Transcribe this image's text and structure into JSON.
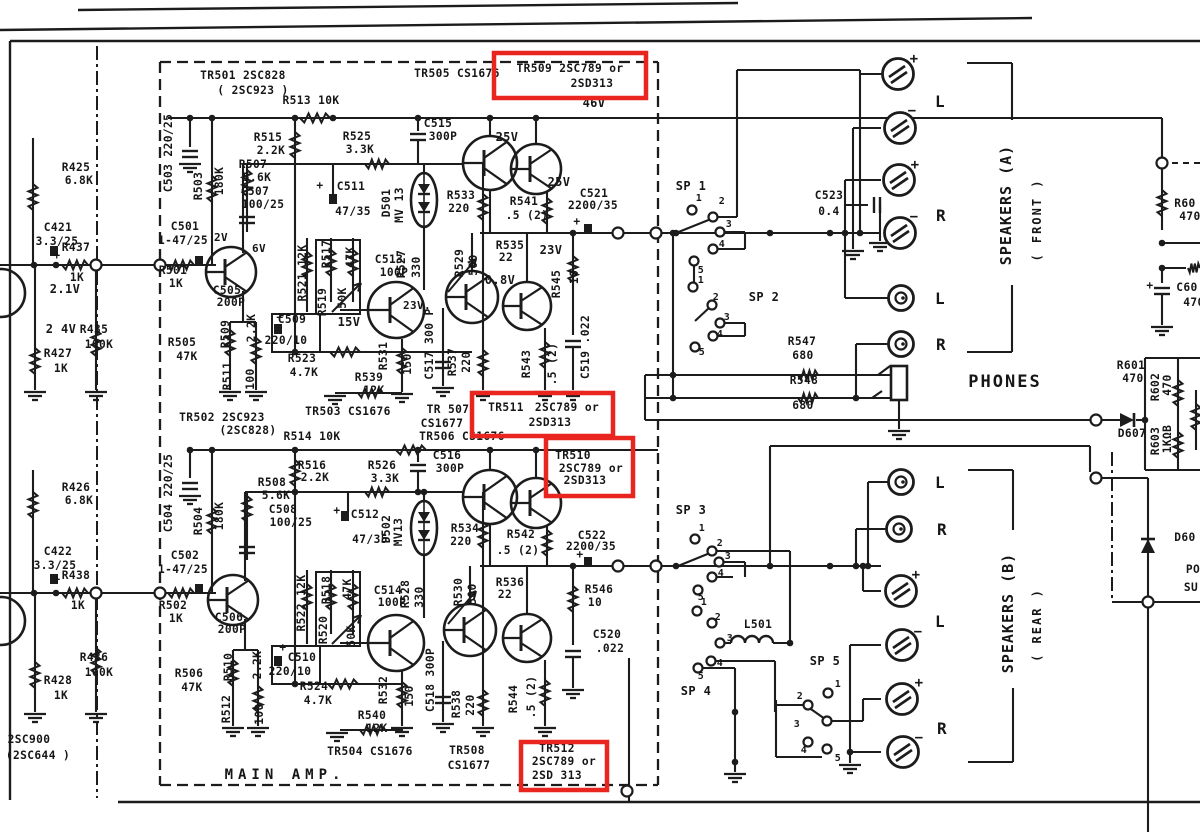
{
  "meta": {
    "document_type": "scanned circuit schematic",
    "section_title": "MAIN AMP",
    "ink_color": "#1c1c1c",
    "paper_color": "#ffffff",
    "highlight_color": "#e8251f"
  },
  "highlights": [
    {
      "name": "tr509-highlight",
      "x": 494,
      "y": 53,
      "w": 152,
      "h": 45
    },
    {
      "name": "tr511-highlight",
      "x": 472,
      "y": 393,
      "w": 141,
      "h": 43
    },
    {
      "name": "tr510-highlight",
      "x": 546,
      "y": 438,
      "w": 87,
      "h": 58
    },
    {
      "name": "tr512-highlight",
      "x": 521,
      "y": 742,
      "w": 86,
      "h": 48
    }
  ],
  "labels": [
    {
      "t": "TR501 2SC828",
      "x": 243,
      "y": 79
    },
    {
      "t": "( 2SC923 )",
      "x": 253,
      "y": 94
    },
    {
      "t": "TR505 CS1676",
      "x": 457,
      "y": 77
    },
    {
      "t": "TR509 2SC789 or",
      "x": 570,
      "y": 72
    },
    {
      "t": "2SD313",
      "x": 592,
      "y": 87
    },
    {
      "t": "46V",
      "x": 594,
      "y": 107,
      "fs": 12
    },
    {
      "t": "R513 10K",
      "x": 311,
      "y": 104
    },
    {
      "t": "R515",
      "x": 268,
      "y": 141
    },
    {
      "t": "2.2K",
      "x": 271,
      "y": 154
    },
    {
      "t": "R525",
      "x": 357,
      "y": 140
    },
    {
      "t": "3.3K",
      "x": 360,
      "y": 153
    },
    {
      "t": "C515",
      "x": 438,
      "y": 127
    },
    {
      "t": "300P",
      "x": 443,
      "y": 140
    },
    {
      "t": "25V",
      "x": 507,
      "y": 141,
      "fs": 12
    },
    {
      "t": "25V",
      "x": 559,
      "y": 186,
      "fs": 12
    },
    {
      "t": "R507",
      "x": 253,
      "y": 168
    },
    {
      "t": "5.6K",
      "x": 257,
      "y": 181
    },
    {
      "t": "C507",
      "x": 255,
      "y": 195
    },
    {
      "t": "100/25",
      "x": 263,
      "y": 208
    },
    {
      "t": "+",
      "x": 320,
      "y": 189
    },
    {
      "t": "C511",
      "x": 351,
      "y": 190
    },
    {
      "t": "47/35",
      "x": 353,
      "y": 215
    },
    {
      "t": "D501",
      "x": 390,
      "y": 203,
      "v": 1
    },
    {
      "t": "MV 13",
      "x": 403,
      "y": 205,
      "v": 1
    },
    {
      "t": "R533",
      "x": 461,
      "y": 199
    },
    {
      "t": "220",
      "x": 459,
      "y": 212
    },
    {
      "t": "R541",
      "x": 524,
      "y": 205
    },
    {
      "t": ".5 (2)",
      "x": 527,
      "y": 219
    },
    {
      "t": "C521",
      "x": 594,
      "y": 197
    },
    {
      "t": "2200/35",
      "x": 593,
      "y": 209
    },
    {
      "t": "+",
      "x": 577,
      "y": 225
    },
    {
      "t": "R535",
      "x": 510,
      "y": 249
    },
    {
      "t": "22",
      "x": 506,
      "y": 261
    },
    {
      "t": "23V",
      "x": 551,
      "y": 254,
      "fs": 12
    },
    {
      "t": "R545",
      "x": 560,
      "y": 284,
      "v": 1
    },
    {
      "t": "10",
      "x": 578,
      "y": 277,
      "v": 1
    },
    {
      "t": "0.8V",
      "x": 500,
      "y": 284,
      "fs": 12
    },
    {
      "t": "23V.",
      "x": 417,
      "y": 309,
      "fs": 11
    },
    {
      "t": "C519 .022",
      "x": 589,
      "y": 347,
      "v": 1
    },
    {
      "t": "R543",
      "x": 530,
      "y": 364,
      "v": 1
    },
    {
      "t": ".5 (2)",
      "x": 556,
      "y": 364,
      "v": 1
    },
    {
      "t": "R537",
      "x": 456,
      "y": 362,
      "v": 1
    },
    {
      "t": "220",
      "x": 470,
      "y": 362,
      "v": 1
    },
    {
      "t": "C517 300 P",
      "x": 433,
      "y": 344,
      "v": 1
    },
    {
      "t": "R531",
      "x": 387,
      "y": 356,
      "v": 1
    },
    {
      "t": "150",
      "x": 411,
      "y": 364,
      "v": 1
    },
    {
      "t": "15V",
      "x": 349,
      "y": 326,
      "fs": 12
    },
    {
      "t": "R521 12K",
      "x": 306,
      "y": 273,
      "v": 1
    },
    {
      "t": "R517",
      "x": 330,
      "y": 254,
      "v": 1
    },
    {
      "t": "R519",
      "x": 326,
      "y": 302,
      "v": 1
    },
    {
      "t": "50K",
      "x": 346,
      "y": 298,
      "v": 1
    },
    {
      "t": "47K",
      "x": 354,
      "y": 257,
      "v": 1
    },
    {
      "t": "C513",
      "x": 389,
      "y": 263
    },
    {
      "t": "100P",
      "x": 394,
      "y": 276
    },
    {
      "t": "R527",
      "x": 405,
      "y": 264,
      "v": 1
    },
    {
      "t": "330",
      "x": 420,
      "y": 267,
      "v": 1
    },
    {
      "t": "R529",
      "x": 463,
      "y": 263,
      "v": 1
    },
    {
      "t": "500",
      "x": 477,
      "y": 265,
      "v": 1
    },
    {
      "t": "+",
      "x": 280,
      "y": 321
    },
    {
      "t": "C509",
      "x": 292,
      "y": 323
    },
    {
      "t": "220/10",
      "x": 286,
      "y": 344
    },
    {
      "t": "R509",
      "x": 229,
      "y": 334,
      "v": 1
    },
    {
      "t": "2.2K",
      "x": 255,
      "y": 328,
      "v": 1
    },
    {
      "t": "R511",
      "x": 231,
      "y": 376,
      "v": 1
    },
    {
      "t": "100",
      "x": 254,
      "y": 379,
      "v": 1
    },
    {
      "t": "R523",
      "x": 302,
      "y": 362
    },
    {
      "t": "4.7K",
      "x": 304,
      "y": 376
    },
    {
      "t": "R539",
      "x": 369,
      "y": 381
    },
    {
      "t": "12K",
      "x": 374,
      "y": 394
    },
    {
      "t": "TR503 CS1676",
      "x": 348,
      "y": 415
    },
    {
      "t": "TR 507",
      "x": 448,
      "y": 413
    },
    {
      "t": "CS1677",
      "x": 442,
      "y": 427
    },
    {
      "t": "TR511",
      "x": 506,
      "y": 411
    },
    {
      "t": "2SC789 or",
      "x": 567,
      "y": 411
    },
    {
      "t": "2SD313",
      "x": 550,
      "y": 426
    },
    {
      "t": "TR506 CS1676",
      "x": 462,
      "y": 440
    },
    {
      "t": "6V",
      "x": 259,
      "y": 252,
      "fs": 11
    },
    {
      "t": "R425",
      "x": 76,
      "y": 171
    },
    {
      "t": "6.8K",
      "x": 79,
      "y": 184
    },
    {
      "t": "C421",
      "x": 58,
      "y": 231
    },
    {
      "t": "3.3/25",
      "x": 57,
      "y": 245
    },
    {
      "t": "+",
      "x": 57,
      "y": 259
    },
    {
      "t": "R437",
      "x": 76,
      "y": 251
    },
    {
      "t": "1K",
      "x": 77,
      "y": 281
    },
    {
      "t": "2.1V",
      "x": 65,
      "y": 293,
      "fs": 12
    },
    {
      "t": "2 4V",
      "x": 61,
      "y": 333,
      "fs": 12
    },
    {
      "t": "R427",
      "x": 58,
      "y": 357
    },
    {
      "t": "1K",
      "x": 61,
      "y": 372
    },
    {
      "t": "R435",
      "x": 94,
      "y": 333
    },
    {
      "t": "100K",
      "x": 99,
      "y": 348
    },
    {
      "t": "C503 220/25",
      "x": 172,
      "y": 153,
      "v": 1
    },
    {
      "t": "R503",
      "x": 202,
      "y": 186,
      "v": 1
    },
    {
      "t": "180K",
      "x": 223,
      "y": 181,
      "v": 1
    },
    {
      "t": "C501",
      "x": 185,
      "y": 230
    },
    {
      "t": "1-47/25",
      "x": 183,
      "y": 244
    },
    {
      "t": "2V",
      "x": 221,
      "y": 241,
      "fs": 11
    },
    {
      "t": "R501",
      "x": 173,
      "y": 274
    },
    {
      "t": "1K",
      "x": 176,
      "y": 287
    },
    {
      "t": "C505",
      "x": 227,
      "y": 294
    },
    {
      "t": "200P",
      "x": 231,
      "y": 306
    },
    {
      "t": "R505",
      "x": 182,
      "y": 346
    },
    {
      "t": "47K",
      "x": 187,
      "y": 360
    },
    {
      "t": "R426",
      "x": 76,
      "y": 491
    },
    {
      "t": "6.8K",
      "x": 79,
      "y": 504
    },
    {
      "t": "C422",
      "x": 58,
      "y": 555
    },
    {
      "t": "3.3/25",
      "x": 55,
      "y": 569
    },
    {
      "t": "+",
      "x": 57,
      "y": 583
    },
    {
      "t": "R438",
      "x": 76,
      "y": 579
    },
    {
      "t": "1K",
      "x": 78,
      "y": 609
    },
    {
      "t": "R436",
      "x": 94,
      "y": 661
    },
    {
      "t": "100K",
      "x": 99,
      "y": 676
    },
    {
      "t": "R428",
      "x": 58,
      "y": 684
    },
    {
      "t": "1K",
      "x": 61,
      "y": 699
    },
    {
      "t": "2SC900",
      "x": 29,
      "y": 743
    },
    {
      "t": "(2SC644 )",
      "x": 38,
      "y": 759
    },
    {
      "t": "C504 220/25",
      "x": 172,
      "y": 493,
      "v": 1
    },
    {
      "t": "R504",
      "x": 202,
      "y": 521,
      "v": 1
    },
    {
      "t": "180K",
      "x": 223,
      "y": 516,
      "v": 1
    },
    {
      "t": "C502",
      "x": 185,
      "y": 559
    },
    {
      "t": "1-47/25",
      "x": 183,
      "y": 573
    },
    {
      "t": "R502",
      "x": 173,
      "y": 609
    },
    {
      "t": "1K",
      "x": 176,
      "y": 622
    },
    {
      "t": "C506",
      "x": 229,
      "y": 621
    },
    {
      "t": "200P",
      "x": 232,
      "y": 633
    },
    {
      "t": "R506",
      "x": 189,
      "y": 677
    },
    {
      "t": "47K",
      "x": 192,
      "y": 691
    },
    {
      "t": "TR502 2SC923",
      "x": 222,
      "y": 421
    },
    {
      "t": "(2SC828)",
      "x": 248,
      "y": 434
    },
    {
      "t": "R514 10K",
      "x": 312,
      "y": 440
    },
    {
      "t": "R516",
      "x": 312,
      "y": 469
    },
    {
      "t": "2.2K",
      "x": 315,
      "y": 481
    },
    {
      "t": "R526",
      "x": 382,
      "y": 469
    },
    {
      "t": "3.3K",
      "x": 385,
      "y": 482
    },
    {
      "t": "C516",
      "x": 447,
      "y": 459
    },
    {
      "t": "300P",
      "x": 450,
      "y": 472
    },
    {
      "t": "R508",
      "x": 272,
      "y": 486
    },
    {
      "t": "5.6K",
      "x": 276,
      "y": 499
    },
    {
      "t": "C508",
      "x": 283,
      "y": 513
    },
    {
      "t": "100/25",
      "x": 291,
      "y": 526
    },
    {
      "t": "+",
      "x": 337,
      "y": 514
    },
    {
      "t": "C512",
      "x": 365,
      "y": 518
    },
    {
      "t": "47/35",
      "x": 370,
      "y": 543
    },
    {
      "t": "D502",
      "x": 390,
      "y": 529,
      "v": 1
    },
    {
      "t": "MV13",
      "x": 402,
      "y": 532,
      "v": 1
    },
    {
      "t": "R534",
      "x": 465,
      "y": 532
    },
    {
      "t": "220",
      "x": 461,
      "y": 545
    },
    {
      "t": "R542",
      "x": 521,
      "y": 538
    },
    {
      "t": ".5 (2)",
      "x": 518,
      "y": 554
    },
    {
      "t": "TR510",
      "x": 573,
      "y": 459
    },
    {
      "t": "2SC789 or",
      "x": 591,
      "y": 472
    },
    {
      "t": "2SD313",
      "x": 585,
      "y": 484
    },
    {
      "t": "C522",
      "x": 592,
      "y": 539
    },
    {
      "t": "2200/35",
      "x": 591,
      "y": 550
    },
    {
      "t": "+",
      "x": 580,
      "y": 558
    },
    {
      "t": "R546",
      "x": 599,
      "y": 593
    },
    {
      "t": "10",
      "x": 595,
      "y": 606
    },
    {
      "t": "C520",
      "x": 607,
      "y": 638
    },
    {
      "t": ".022",
      "x": 610,
      "y": 652
    },
    {
      "t": "R536",
      "x": 510,
      "y": 586
    },
    {
      "t": "22",
      "x": 505,
      "y": 598
    },
    {
      "t": "R522 12K",
      "x": 305,
      "y": 603,
      "v": 1
    },
    {
      "t": "R518",
      "x": 330,
      "y": 590,
      "v": 1
    },
    {
      "t": "47K",
      "x": 351,
      "y": 589,
      "v": 1
    },
    {
      "t": "R520",
      "x": 327,
      "y": 630,
      "v": 1
    },
    {
      "t": "50K",
      "x": 355,
      "y": 636,
      "v": 1
    },
    {
      "t": "C514",
      "x": 388,
      "y": 594
    },
    {
      "t": "100P",
      "x": 392,
      "y": 606
    },
    {
      "t": "R528",
      "x": 409,
      "y": 594,
      "v": 1
    },
    {
      "t": "330",
      "x": 423,
      "y": 597,
      "v": 1
    },
    {
      "t": "R530",
      "x": 462,
      "y": 592,
      "v": 1
    },
    {
      "t": "500",
      "x": 476,
      "y": 594,
      "v": 1
    },
    {
      "t": "+",
      "x": 283,
      "y": 651
    },
    {
      "t": "C510",
      "x": 302,
      "y": 661
    },
    {
      "t": "220/10",
      "x": 290,
      "y": 675
    },
    {
      "t": "R510",
      "x": 232,
      "y": 667,
      "v": 1
    },
    {
      "t": "2.2K",
      "x": 261,
      "y": 665,
      "v": 1
    },
    {
      "t": "R512",
      "x": 230,
      "y": 709,
      "v": 1
    },
    {
      "t": "100",
      "x": 263,
      "y": 714,
      "v": 1
    },
    {
      "t": "R524",
      "x": 314,
      "y": 690
    },
    {
      "t": "4.7K",
      "x": 318,
      "y": 704
    },
    {
      "t": "R540",
      "x": 372,
      "y": 719
    },
    {
      "t": "12K",
      "x": 377,
      "y": 732
    },
    {
      "t": "R532",
      "x": 387,
      "y": 690,
      "v": 1
    },
    {
      "t": "150",
      "x": 413,
      "y": 696,
      "v": 1
    },
    {
      "t": "C518 300P",
      "x": 434,
      "y": 680,
      "v": 1
    },
    {
      "t": "R538",
      "x": 460,
      "y": 704,
      "v": 1
    },
    {
      "t": "220",
      "x": 474,
      "y": 705,
      "v": 1
    },
    {
      "t": "R544",
      "x": 517,
      "y": 699,
      "v": 1
    },
    {
      "t": ".5 (2)",
      "x": 535,
      "y": 697,
      "v": 1
    },
    {
      "t": "TR504 CS1676",
      "x": 370,
      "y": 755
    },
    {
      "t": "TR508",
      "x": 467,
      "y": 754
    },
    {
      "t": "CS1677",
      "x": 469,
      "y": 769
    },
    {
      "t": "TR512",
      "x": 557,
      "y": 752
    },
    {
      "t": "2SC789 or",
      "x": 564,
      "y": 765
    },
    {
      "t": "2SD 313",
      "x": 557,
      "y": 779
    },
    {
      "t": "MAIN  AMP.",
      "x": 285,
      "y": 779,
      "fs": 14,
      "ls": 5
    },
    {
      "t": "SP 1",
      "x": 691,
      "y": 190,
      "fs": 12
    },
    {
      "t": "1",
      "x": 699,
      "y": 201,
      "fs": 10
    },
    {
      "t": "2",
      "x": 722,
      "y": 204,
      "fs": 10
    },
    {
      "t": "3",
      "x": 729,
      "y": 227,
      "fs": 10
    },
    {
      "t": "4",
      "x": 722,
      "y": 247,
      "fs": 10
    },
    {
      "t": "5",
      "x": 701,
      "y": 273,
      "fs": 10
    },
    {
      "t": "SP 2",
      "x": 764,
      "y": 301,
      "fs": 12
    },
    {
      "t": "1",
      "x": 701,
      "y": 283,
      "fs": 10
    },
    {
      "t": "2",
      "x": 716,
      "y": 300,
      "fs": 10
    },
    {
      "t": "3",
      "x": 727,
      "y": 320,
      "fs": 10
    },
    {
      "t": "4",
      "x": 720,
      "y": 337,
      "fs": 10
    },
    {
      "t": "5",
      "x": 702,
      "y": 355,
      "fs": 10
    },
    {
      "t": "C523",
      "x": 829,
      "y": 199
    },
    {
      "t": "0.4",
      "x": 829,
      "y": 215
    },
    {
      "t": "R547",
      "x": 802,
      "y": 345
    },
    {
      "t": "680",
      "x": 803,
      "y": 359
    },
    {
      "t": "R548",
      "x": 804,
      "y": 384
    },
    {
      "t": "680",
      "x": 803,
      "y": 409
    },
    {
      "t": "PHONES",
      "x": 1005,
      "y": 387,
      "fs": 17,
      "ls": 2
    },
    {
      "t": "SP 3",
      "x": 691,
      "y": 514,
      "fs": 12
    },
    {
      "t": "1",
      "x": 702,
      "y": 531,
      "fs": 10
    },
    {
      "t": "2",
      "x": 720,
      "y": 546,
      "fs": 10
    },
    {
      "t": "3",
      "x": 728,
      "y": 559,
      "fs": 10
    },
    {
      "t": "4",
      "x": 721,
      "y": 576,
      "fs": 10
    },
    {
      "t": "5",
      "x": 701,
      "y": 600,
      "fs": 10
    },
    {
      "t": "L501",
      "x": 758,
      "y": 628
    },
    {
      "t": "SP 4",
      "x": 696,
      "y": 695,
      "fs": 12
    },
    {
      "t": "1",
      "x": 704,
      "y": 605,
      "fs": 10
    },
    {
      "t": "2",
      "x": 718,
      "y": 620,
      "fs": 10
    },
    {
      "t": "3",
      "x": 730,
      "y": 641,
      "fs": 10
    },
    {
      "t": "4",
      "x": 720,
      "y": 666,
      "fs": 10
    },
    {
      "t": "5",
      "x": 701,
      "y": 679,
      "fs": 10
    },
    {
      "t": "SP 5",
      "x": 825,
      "y": 665,
      "fs": 12
    },
    {
      "t": "1",
      "x": 838,
      "y": 687,
      "fs": 10
    },
    {
      "t": "2",
      "x": 800,
      "y": 699,
      "fs": 10
    },
    {
      "t": "3",
      "x": 797,
      "y": 727,
      "fs": 10
    },
    {
      "t": "4",
      "x": 804,
      "y": 753,
      "fs": 10
    },
    {
      "t": "5",
      "x": 838,
      "y": 761,
      "fs": 10
    },
    {
      "t": "+",
      "x": 914,
      "y": 63,
      "fs": 14
    },
    {
      "t": "−",
      "x": 912,
      "y": 115,
      "fs": 14
    },
    {
      "t": "+",
      "x": 915,
      "y": 169,
      "fs": 14
    },
    {
      "t": "−",
      "x": 914,
      "y": 221,
      "fs": 14
    },
    {
      "t": "L",
      "x": 940,
      "y": 107,
      "fs": 16
    },
    {
      "t": "R",
      "x": 941,
      "y": 221,
      "fs": 16
    },
    {
      "t": "L",
      "x": 940,
      "y": 304,
      "fs": 16
    },
    {
      "t": "R",
      "x": 941,
      "y": 350,
      "fs": 16
    },
    {
      "t": "SPEAKERS (A)",
      "x": 1011,
      "y": 205,
      "v": 1,
      "fs": 15,
      "ls": 1
    },
    {
      "t": "( FRONT )",
      "x": 1041,
      "y": 220,
      "v": 1,
      "fs": 12,
      "ls": 2
    },
    {
      "t": "L",
      "x": 940,
      "y": 488,
      "fs": 16
    },
    {
      "t": "R",
      "x": 942,
      "y": 535,
      "fs": 16
    },
    {
      "t": "+",
      "x": 916,
      "y": 579,
      "fs": 14
    },
    {
      "t": "L",
      "x": 940,
      "y": 627,
      "fs": 16
    },
    {
      "t": "−",
      "x": 918,
      "y": 636,
      "fs": 14
    },
    {
      "t": "+",
      "x": 919,
      "y": 687,
      "fs": 14
    },
    {
      "t": "R",
      "x": 942,
      "y": 734,
      "fs": 16
    },
    {
      "t": "−",
      "x": 919,
      "y": 742,
      "fs": 14
    },
    {
      "t": "SPEAKERS (B)",
      "x": 1013,
      "y": 613,
      "v": 1,
      "fs": 15,
      "ls": 1
    },
    {
      "t": "( REAR )",
      "x": 1041,
      "y": 625,
      "v": 1,
      "fs": 12,
      "ls": 2
    },
    {
      "t": "R60",
      "x": 1185,
      "y": 207
    },
    {
      "t": "470",
      "x": 1190,
      "y": 220
    },
    {
      "t": "+",
      "x": 1150,
      "y": 289
    },
    {
      "t": "C60",
      "x": 1187,
      "y": 291
    },
    {
      "t": "470",
      "x": 1194,
      "y": 306
    },
    {
      "t": "R601",
      "x": 1131,
      "y": 369
    },
    {
      "t": "470",
      "x": 1133,
      "y": 382
    },
    {
      "t": "R602",
      "x": 1159,
      "y": 387,
      "v": 1
    },
    {
      "t": "470",
      "x": 1171,
      "y": 385,
      "v": 1
    },
    {
      "t": "R603",
      "x": 1159,
      "y": 441,
      "v": 1
    },
    {
      "t": "1KΩB",
      "x": 1171,
      "y": 439,
      "v": 1
    },
    {
      "t": "D607",
      "x": 1132,
      "y": 437
    },
    {
      "t": "D60",
      "x": 1185,
      "y": 541
    },
    {
      "t": "PO",
      "x": 1193,
      "y": 573
    },
    {
      "t": "SU",
      "x": 1191,
      "y": 591
    }
  ]
}
